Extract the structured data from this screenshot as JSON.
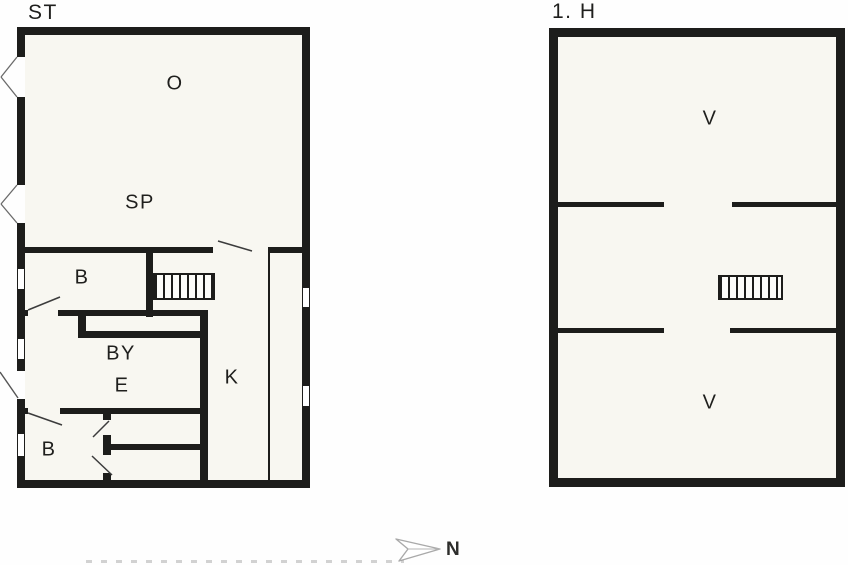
{
  "colors": {
    "wall": "#1d1d1b",
    "floor": "#f8f7f1",
    "bg": "#fefefe",
    "swing": "#3c3c3c",
    "glass": "#777777",
    "arrow": "#a9a9a9",
    "text": "#1f1f1d"
  },
  "floorplan_left": {
    "title": "ST",
    "rooms": [
      {
        "id": "O",
        "label": "O"
      },
      {
        "id": "SP",
        "label": "SP"
      },
      {
        "id": "B-upper",
        "label": "B"
      },
      {
        "id": "BY",
        "label": "BY"
      },
      {
        "id": "E",
        "label": "E"
      },
      {
        "id": "K",
        "label": "K"
      },
      {
        "id": "B-lower",
        "label": "B"
      }
    ]
  },
  "floorplan_right": {
    "title": "1. H",
    "rooms": [
      {
        "id": "V-north",
        "label": "V"
      },
      {
        "id": "V-south",
        "label": "V"
      }
    ]
  },
  "compass": {
    "label": "N"
  }
}
